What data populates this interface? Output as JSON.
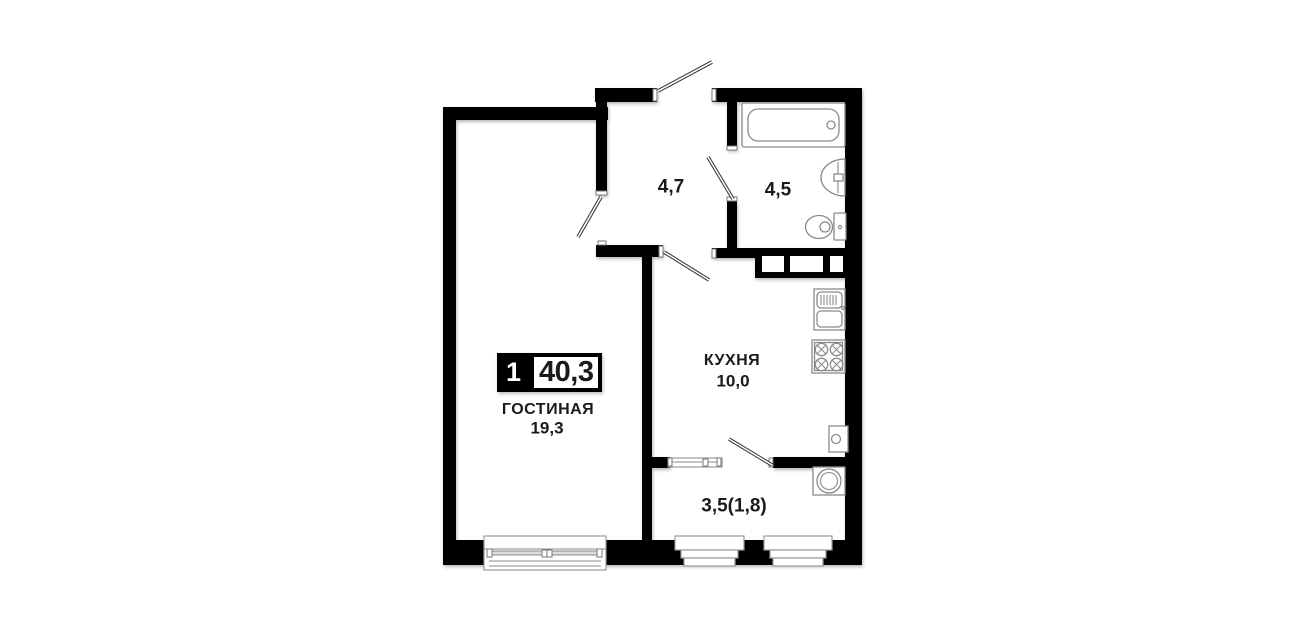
{
  "unit": {
    "rooms_count": "1",
    "total_area": "40,3"
  },
  "rooms": {
    "living": {
      "name": "ГОСТИНАЯ",
      "area": "19,3"
    },
    "kitchen": {
      "name": "КУХНЯ",
      "area": "10,0"
    },
    "hallway": {
      "area": "4,7"
    },
    "bathroom": {
      "area": "4,5"
    },
    "balcony": {
      "area": "3,5(1,8)"
    }
  },
  "fixtures": [
    "bathtub",
    "bathroom-sink",
    "toilet",
    "kitchen-sink",
    "stove",
    "boiler",
    "washing-machine"
  ],
  "colors": {
    "wall": "#000000",
    "fixture": "#8a8a8a",
    "text": "#1a1a1a",
    "background": "#ffffff"
  }
}
